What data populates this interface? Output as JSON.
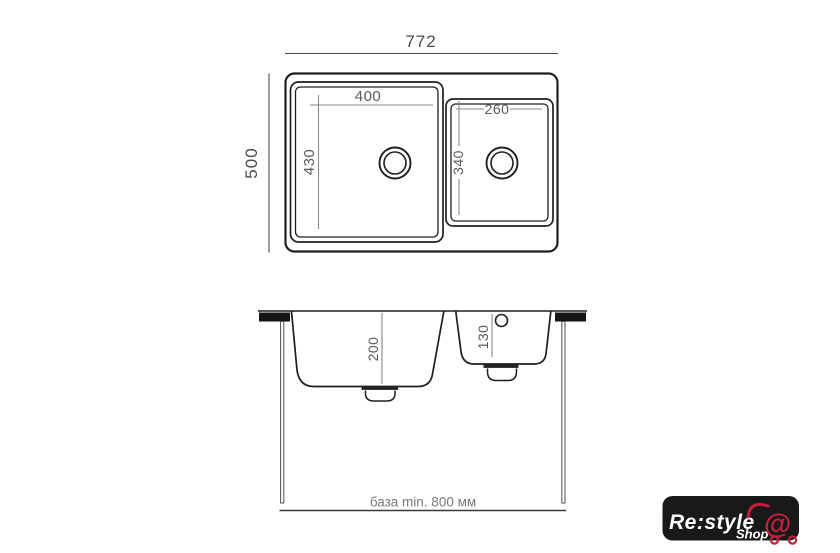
{
  "colors": {
    "background": "#ffffff",
    "drawing_outline": "#1f1f1f",
    "frame_dimension": "#4a4a4a",
    "inner_dimension_line": "#8a8a8a",
    "dimension_text": "#5a5a5a",
    "base_note_text": "#7a7a7a",
    "countertop_fill": "#141414",
    "logo_background": "#191919",
    "logo_text": "#ffffff",
    "logo_accent": "#c41f3e"
  },
  "plan_view": {
    "overall_width": "772",
    "overall_depth": "500",
    "main_bowl": {
      "width": "400",
      "depth": "430"
    },
    "second_bowl": {
      "width": "260",
      "depth": "340"
    }
  },
  "section_view": {
    "main_bowl_depth": "200",
    "second_bowl_depth": "130",
    "base_note": "база min. 800 мм"
  },
  "logo": {
    "brand": "Re:style",
    "sub_brand": "Shop",
    "cart_at_symbol": "@"
  },
  "dimensions_mm": {
    "overall": [
      772,
      500
    ],
    "main_bowl": [
      400,
      430,
      200
    ],
    "second_bowl": [
      260,
      340,
      130
    ],
    "base_min": 800
  }
}
